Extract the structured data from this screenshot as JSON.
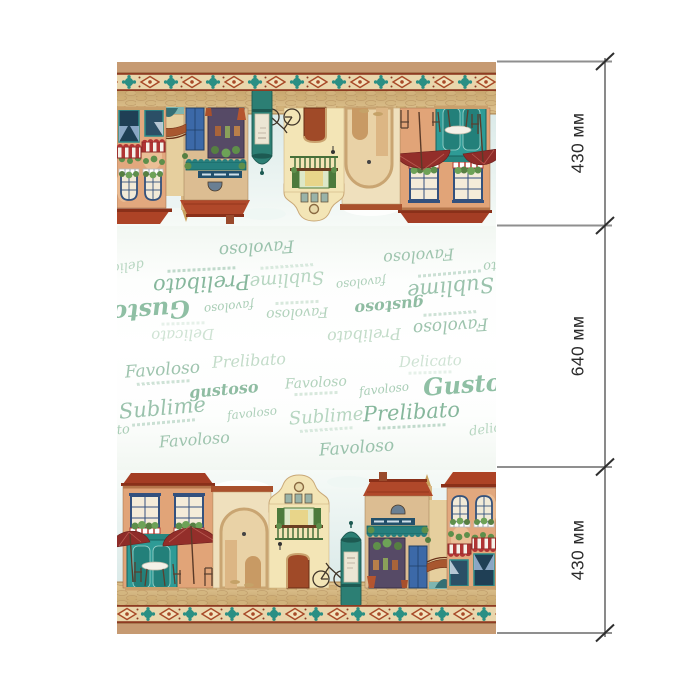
{
  "dimensions": {
    "unit": "мм",
    "segments": [
      {
        "label": "430 мм",
        "value": 430
      },
      {
        "label": "640 мм",
        "value": 640
      },
      {
        "label": "430 мм",
        "value": 430
      }
    ]
  },
  "fabric": {
    "words": [
      {
        "text": "Favoloso",
        "x": 8,
        "y": 14,
        "size": 17,
        "color": "#9ec4ae",
        "tilt": -4,
        "weight": 400,
        "caption": true
      },
      {
        "text": "Prelibato",
        "x": 95,
        "y": 5,
        "size": 16,
        "color": "#c3dcc9",
        "tilt": -3,
        "weight": 400,
        "caption": false
      },
      {
        "text": "Delicato",
        "x": 282,
        "y": 6,
        "size": 15,
        "color": "#cfe3d4",
        "tilt": -2,
        "weight": 400,
        "caption": true
      },
      {
        "text": "gustoso",
        "x": 72,
        "y": 34,
        "size": 16,
        "color": "#8fbca2",
        "tilt": -5,
        "weight": 700,
        "caption": false
      },
      {
        "text": "Favoloso",
        "x": 168,
        "y": 28,
        "size": 14,
        "color": "#b2d2bc",
        "tilt": -3,
        "weight": 400,
        "caption": true
      },
      {
        "text": "favoloso",
        "x": 242,
        "y": 35,
        "size": 12,
        "color": "#a9cdb6",
        "tilt": -6,
        "weight": 400,
        "caption": false
      },
      {
        "text": "Gustoso",
        "x": 306,
        "y": 24,
        "size": 24,
        "color": "#8fbfa4",
        "tilt": -4,
        "weight": 700,
        "caption": false
      },
      {
        "text": "Sublime",
        "x": 2,
        "y": 50,
        "size": 21,
        "color": "#9ac2ac",
        "tilt": -5,
        "weight": 400,
        "caption": true
      },
      {
        "text": "favoloso",
        "x": 110,
        "y": 59,
        "size": 12,
        "color": "#aed0ba",
        "tilt": -6,
        "weight": 400,
        "caption": false
      },
      {
        "text": "Sublime",
        "x": 172,
        "y": 60,
        "size": 18,
        "color": "#b7d6c1",
        "tilt": -4,
        "weight": 400,
        "caption": true
      },
      {
        "text": "Prelibato",
        "x": 246,
        "y": 54,
        "size": 21,
        "color": "#86b79c",
        "tilt": -3,
        "weight": 400,
        "caption": true
      },
      {
        "text": "delicato",
        "x": 352,
        "y": 74,
        "size": 13,
        "color": "#b7d6c1",
        "tilt": -8,
        "weight": 400,
        "caption": false
      },
      {
        "text": "ato",
        "x": -8,
        "y": 76,
        "size": 13,
        "color": "#a9cdb6",
        "tilt": -6,
        "weight": 400,
        "caption": false
      },
      {
        "text": "Favoloso",
        "x": 42,
        "y": 84,
        "size": 16,
        "color": "#9ec4ae",
        "tilt": -4,
        "weight": 400,
        "caption": false
      },
      {
        "text": "Favoloso",
        "x": 202,
        "y": 92,
        "size": 17,
        "color": "#9ac2ac",
        "tilt": -4,
        "weight": 400,
        "caption": false
      }
    ]
  },
  "palette": {
    "selvedge_tan": "#c69a72",
    "border_background": "#e9d6ac",
    "border_rust": "#a84a28",
    "border_teal": "#2a8f84",
    "word_green": "#9ac2ac",
    "roof_red": "#ad4326",
    "storefront_teal": "#2e9b96",
    "umbrella_red": "#8e2c29",
    "street_tan": "#d7bd8c",
    "sky_pale": "#d9e9e8",
    "dimension_line_gray": "#8f8f8f",
    "dimension_text": "#2b2b2b"
  }
}
